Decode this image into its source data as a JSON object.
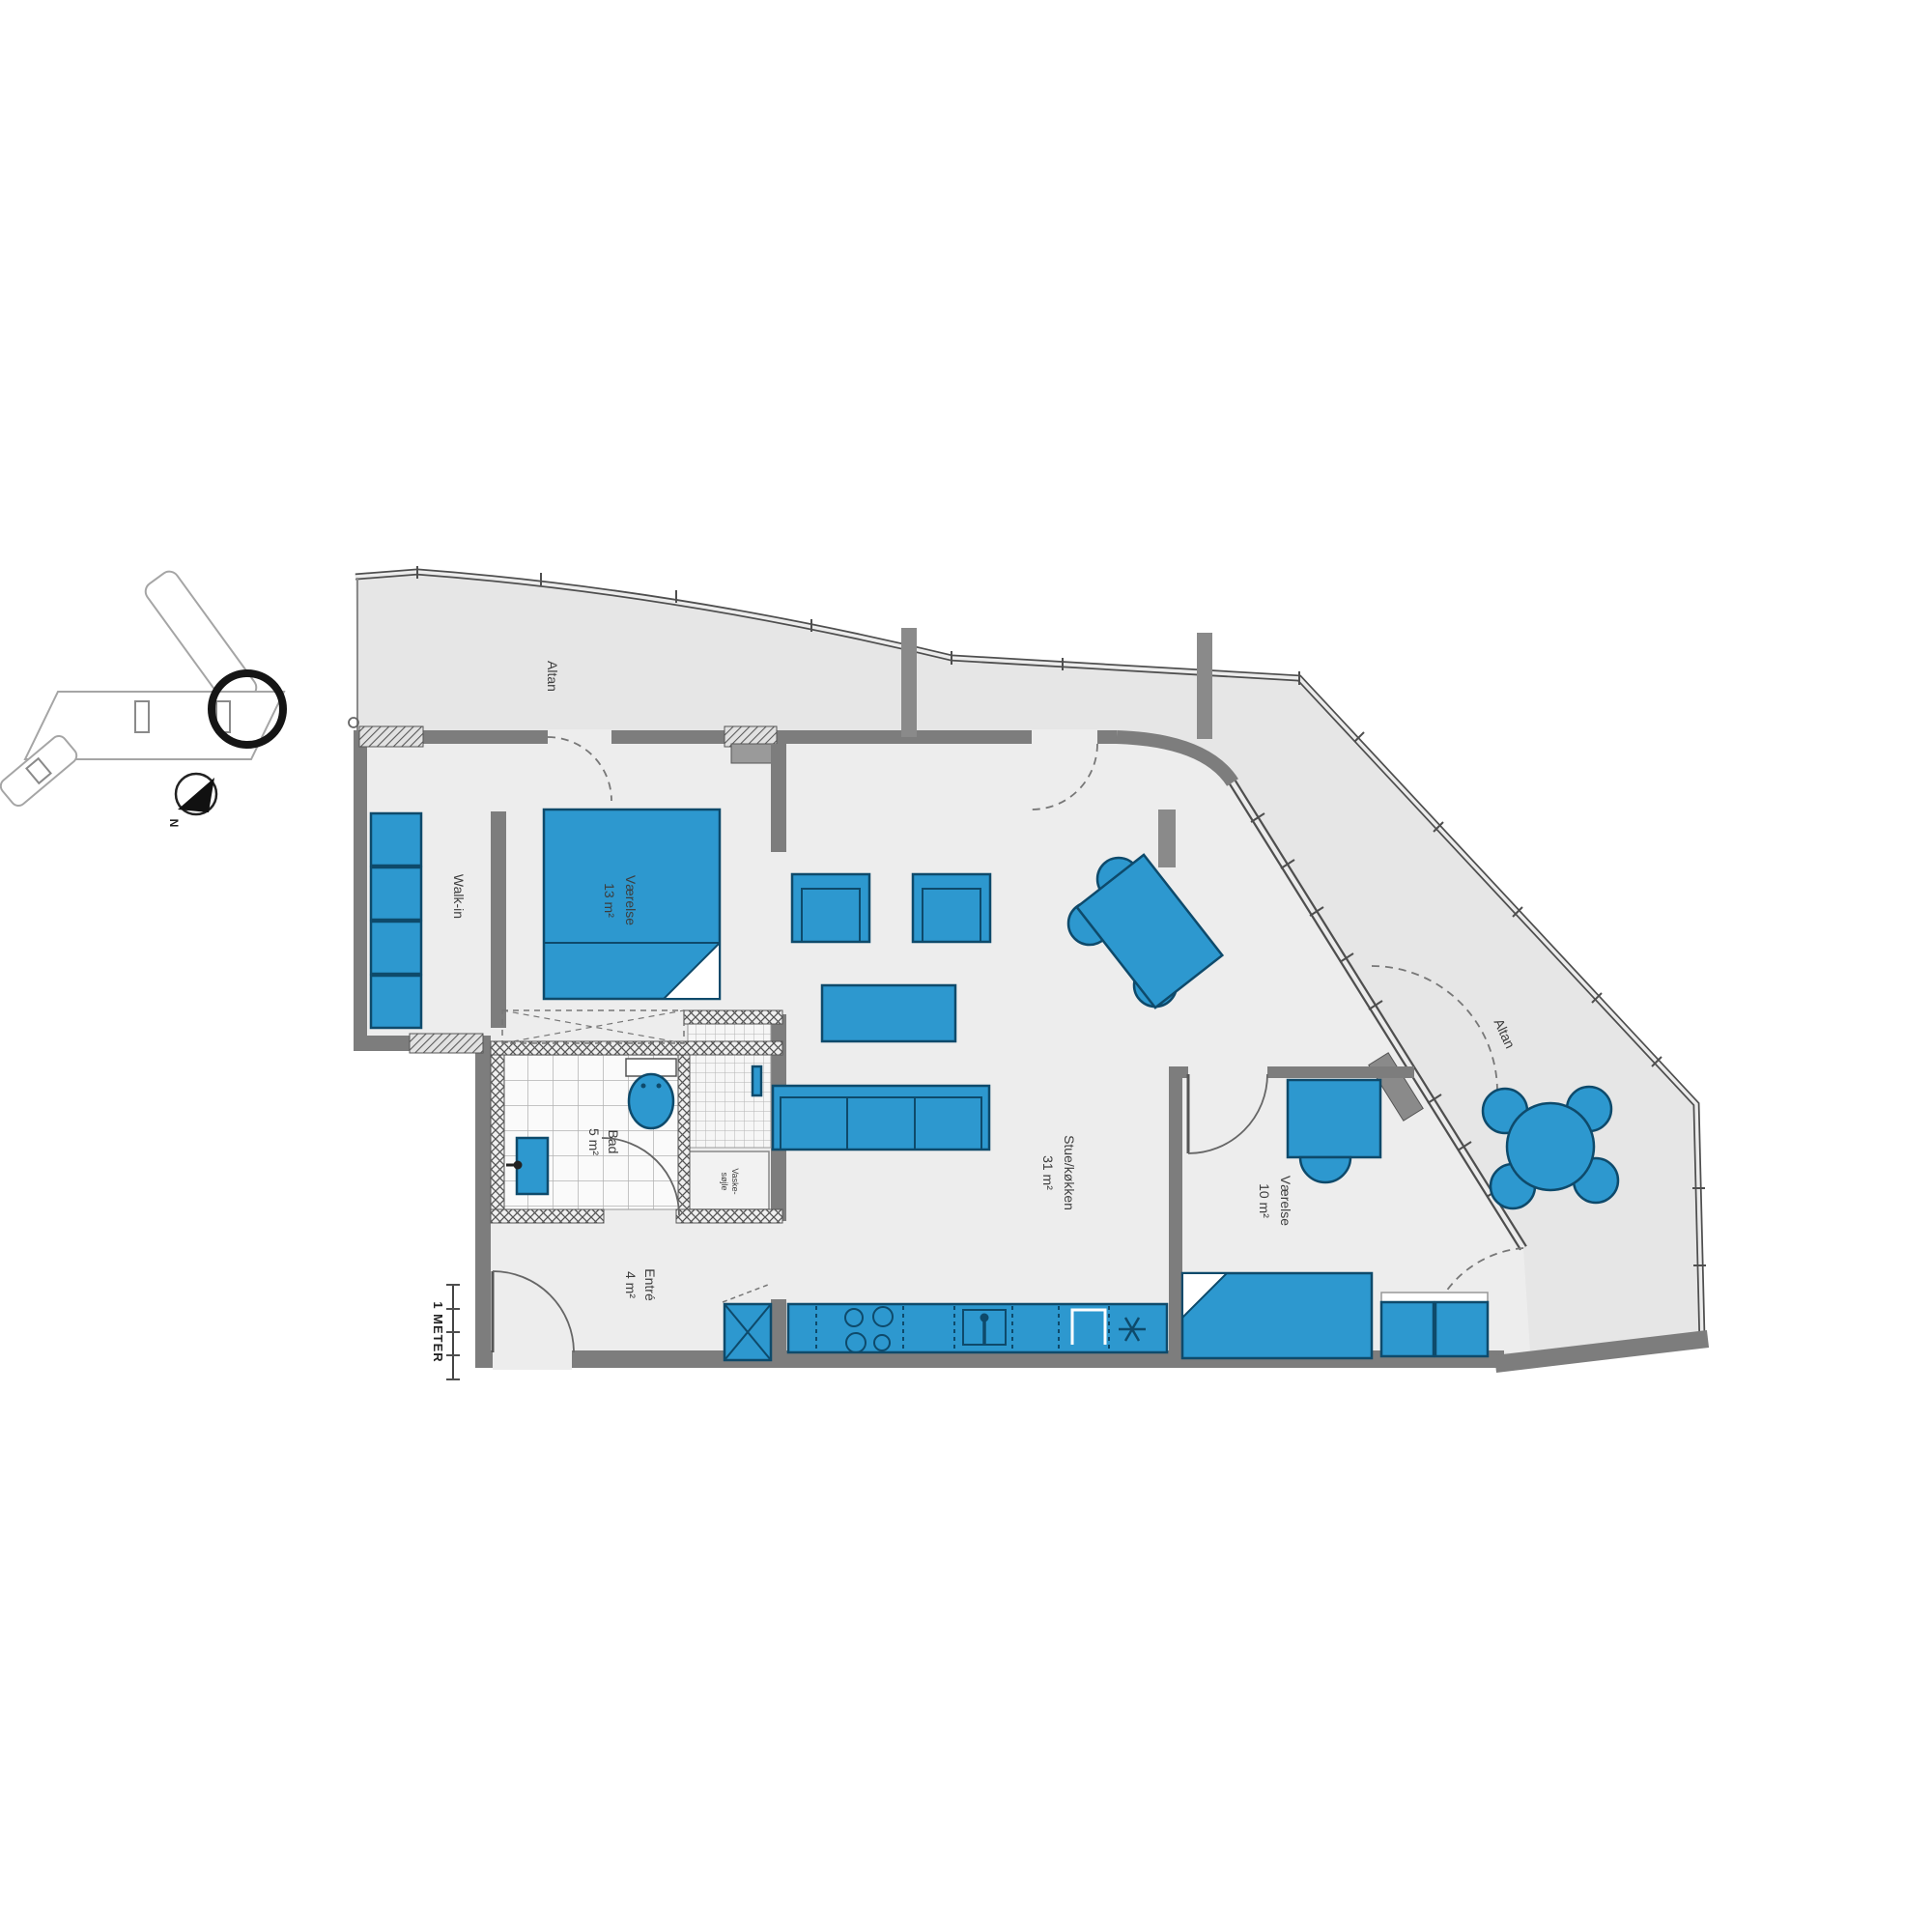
{
  "rooms": [
    {
      "key": "balcony-top",
      "label": "Altan"
    },
    {
      "key": "walk-in",
      "label": "Walk-in"
    },
    {
      "key": "bedroom-1",
      "label": "Værelse",
      "area": "13 m²"
    },
    {
      "key": "bathroom",
      "label": "Bad",
      "area": "5 m²"
    },
    {
      "key": "laundry-column",
      "label": "Vaske-",
      "label2": "søjle"
    },
    {
      "key": "entry",
      "label": "Entré",
      "area": "4 m²"
    },
    {
      "key": "living-kitchen",
      "label": "Stue/køkken",
      "area": "31 m²"
    },
    {
      "key": "bedroom-2",
      "label": "Værelse",
      "area": "10 m²"
    },
    {
      "key": "balcony-right",
      "label": "Altan"
    }
  ],
  "scale_bar": {
    "label": "1 METER"
  },
  "compass": {
    "label": "N"
  },
  "colors": {
    "furniture": "#2d98cf",
    "furniture_stroke": "#0e4a6b",
    "wall": "#7d7d7d",
    "floor_balcony": "#e6e6e6",
    "floor_interior": "#ededed"
  }
}
